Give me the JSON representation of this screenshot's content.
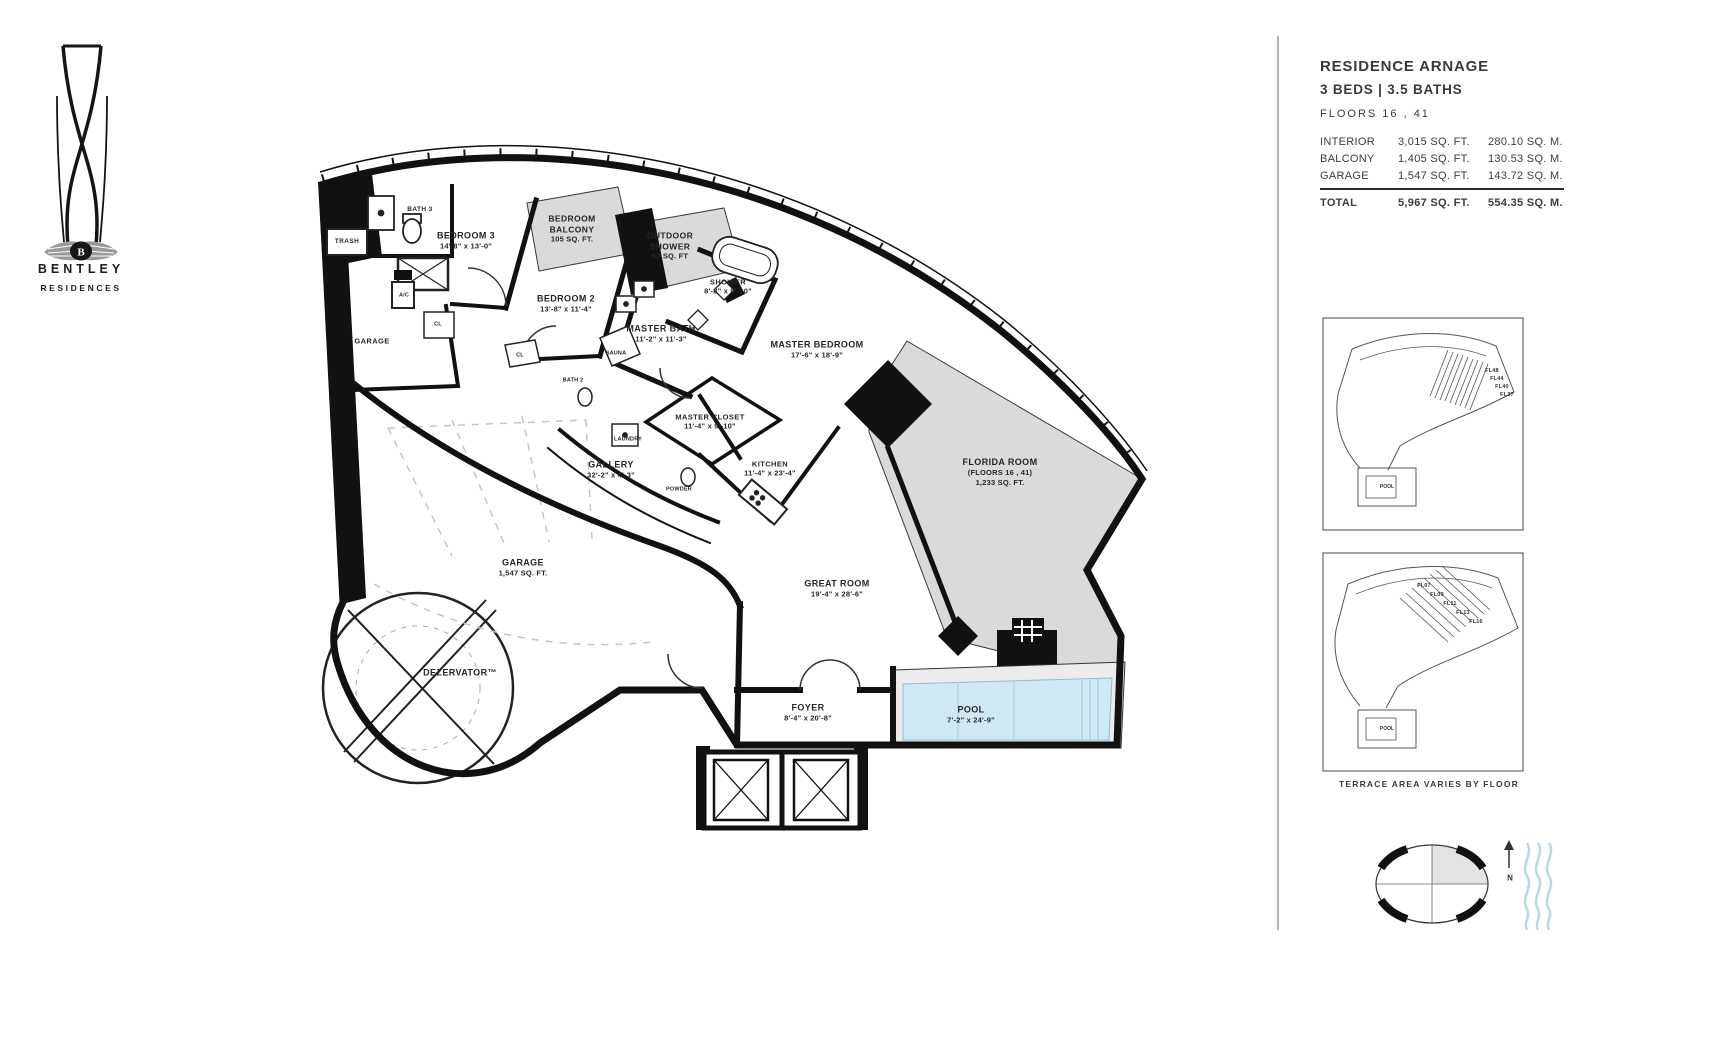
{
  "brand": {
    "name": "BENTLEY",
    "subtitle": "RESIDENCES",
    "logo_letter": "B"
  },
  "panel": {
    "title": "RESIDENCE ARNAGE",
    "beds_baths": "3 BEDS | 3.5 BATHS",
    "floors": "FLOORS 16 , 41",
    "area_table": {
      "rows": [
        {
          "label": "INTERIOR",
          "sqft": "3,015 SQ. FT.",
          "sqm": "280.10 SQ. M."
        },
        {
          "label": "BALCONY",
          "sqft": "1,405 SQ. FT.",
          "sqm": "130.53 SQ. M."
        },
        {
          "label": "GARAGE",
          "sqft": "1,547 SQ. FT.",
          "sqm": "143.72 SQ. M."
        }
      ],
      "total": {
        "label": "TOTAL",
        "sqft": "5,967 SQ. FT.",
        "sqm": "554.35 SQ. M."
      }
    },
    "inset_top": {
      "floor_labels": [
        "FL48",
        "FL44",
        "FL40",
        "FL37"
      ],
      "pool_label": "POOL"
    },
    "inset_bottom": {
      "floor_labels": [
        "FL07",
        "FL09",
        "FL11",
        "FL13",
        "FL16"
      ],
      "pool_label": "POOL"
    },
    "footnote": "TERRACE AREA VARIES BY FLOOR",
    "compass_north": "N"
  },
  "floorplan": {
    "rooms": [
      {
        "name": "BATH 3"
      },
      {
        "name": "TRASH"
      },
      {
        "name": "BEDROOM 3",
        "dims": "14'-8\" x 13'-0\""
      },
      {
        "name": "A/C"
      },
      {
        "name": "GARAGE"
      },
      {
        "name": "CL"
      },
      {
        "name": "CL"
      },
      {
        "name": "BEDROOM 2",
        "dims": "13'-8\" x 11'-4\""
      },
      {
        "name": "BEDROOM BALCONY",
        "area": "105 SQ. FT."
      },
      {
        "name": "OUTDOOR SHOWER",
        "area": "67 SQ. FT"
      },
      {
        "name": "SHOWER",
        "dims": "8'-8\" x 9'-10\""
      },
      {
        "name": "MASTER BATH",
        "dims": "11'-2\" x 11'-3\""
      },
      {
        "name": "SAUNA"
      },
      {
        "name": "BATH 2"
      },
      {
        "name": "MASTER BEDROOM",
        "dims": "17'-6\" x 18'-9\""
      },
      {
        "name": "MASTER CLOSET",
        "dims": "11'-4\" x 9'-10\""
      },
      {
        "name": "LAUNDRY"
      },
      {
        "name": "GALLERY",
        "dims": "32'-2\" x 4'-3\""
      },
      {
        "name": "POWDER"
      },
      {
        "name": "KITCHEN",
        "dims": "11'-4\" x 23'-4\""
      },
      {
        "name": "FLORIDA ROOM",
        "floors_note": "(FLOORS 16 , 41)",
        "area": "1,233 SQ. FT."
      },
      {
        "name": "GARAGE",
        "area": "1,547 SQ. FT."
      },
      {
        "name": "GREAT ROOM",
        "dims": "19'-4\" x 28'-6\""
      },
      {
        "name": "DEZERVATOR™"
      },
      {
        "name": "FOYER",
        "dims": "8'-4\" x 20'-8\""
      },
      {
        "name": "POOL",
        "dims": "7'-2\" x 24'-9\""
      }
    ],
    "colors": {
      "balcony_fill": "#dadada",
      "pool_water": "#cfe9f2",
      "wall": "#111111",
      "waves": "#b5d9e6"
    }
  }
}
